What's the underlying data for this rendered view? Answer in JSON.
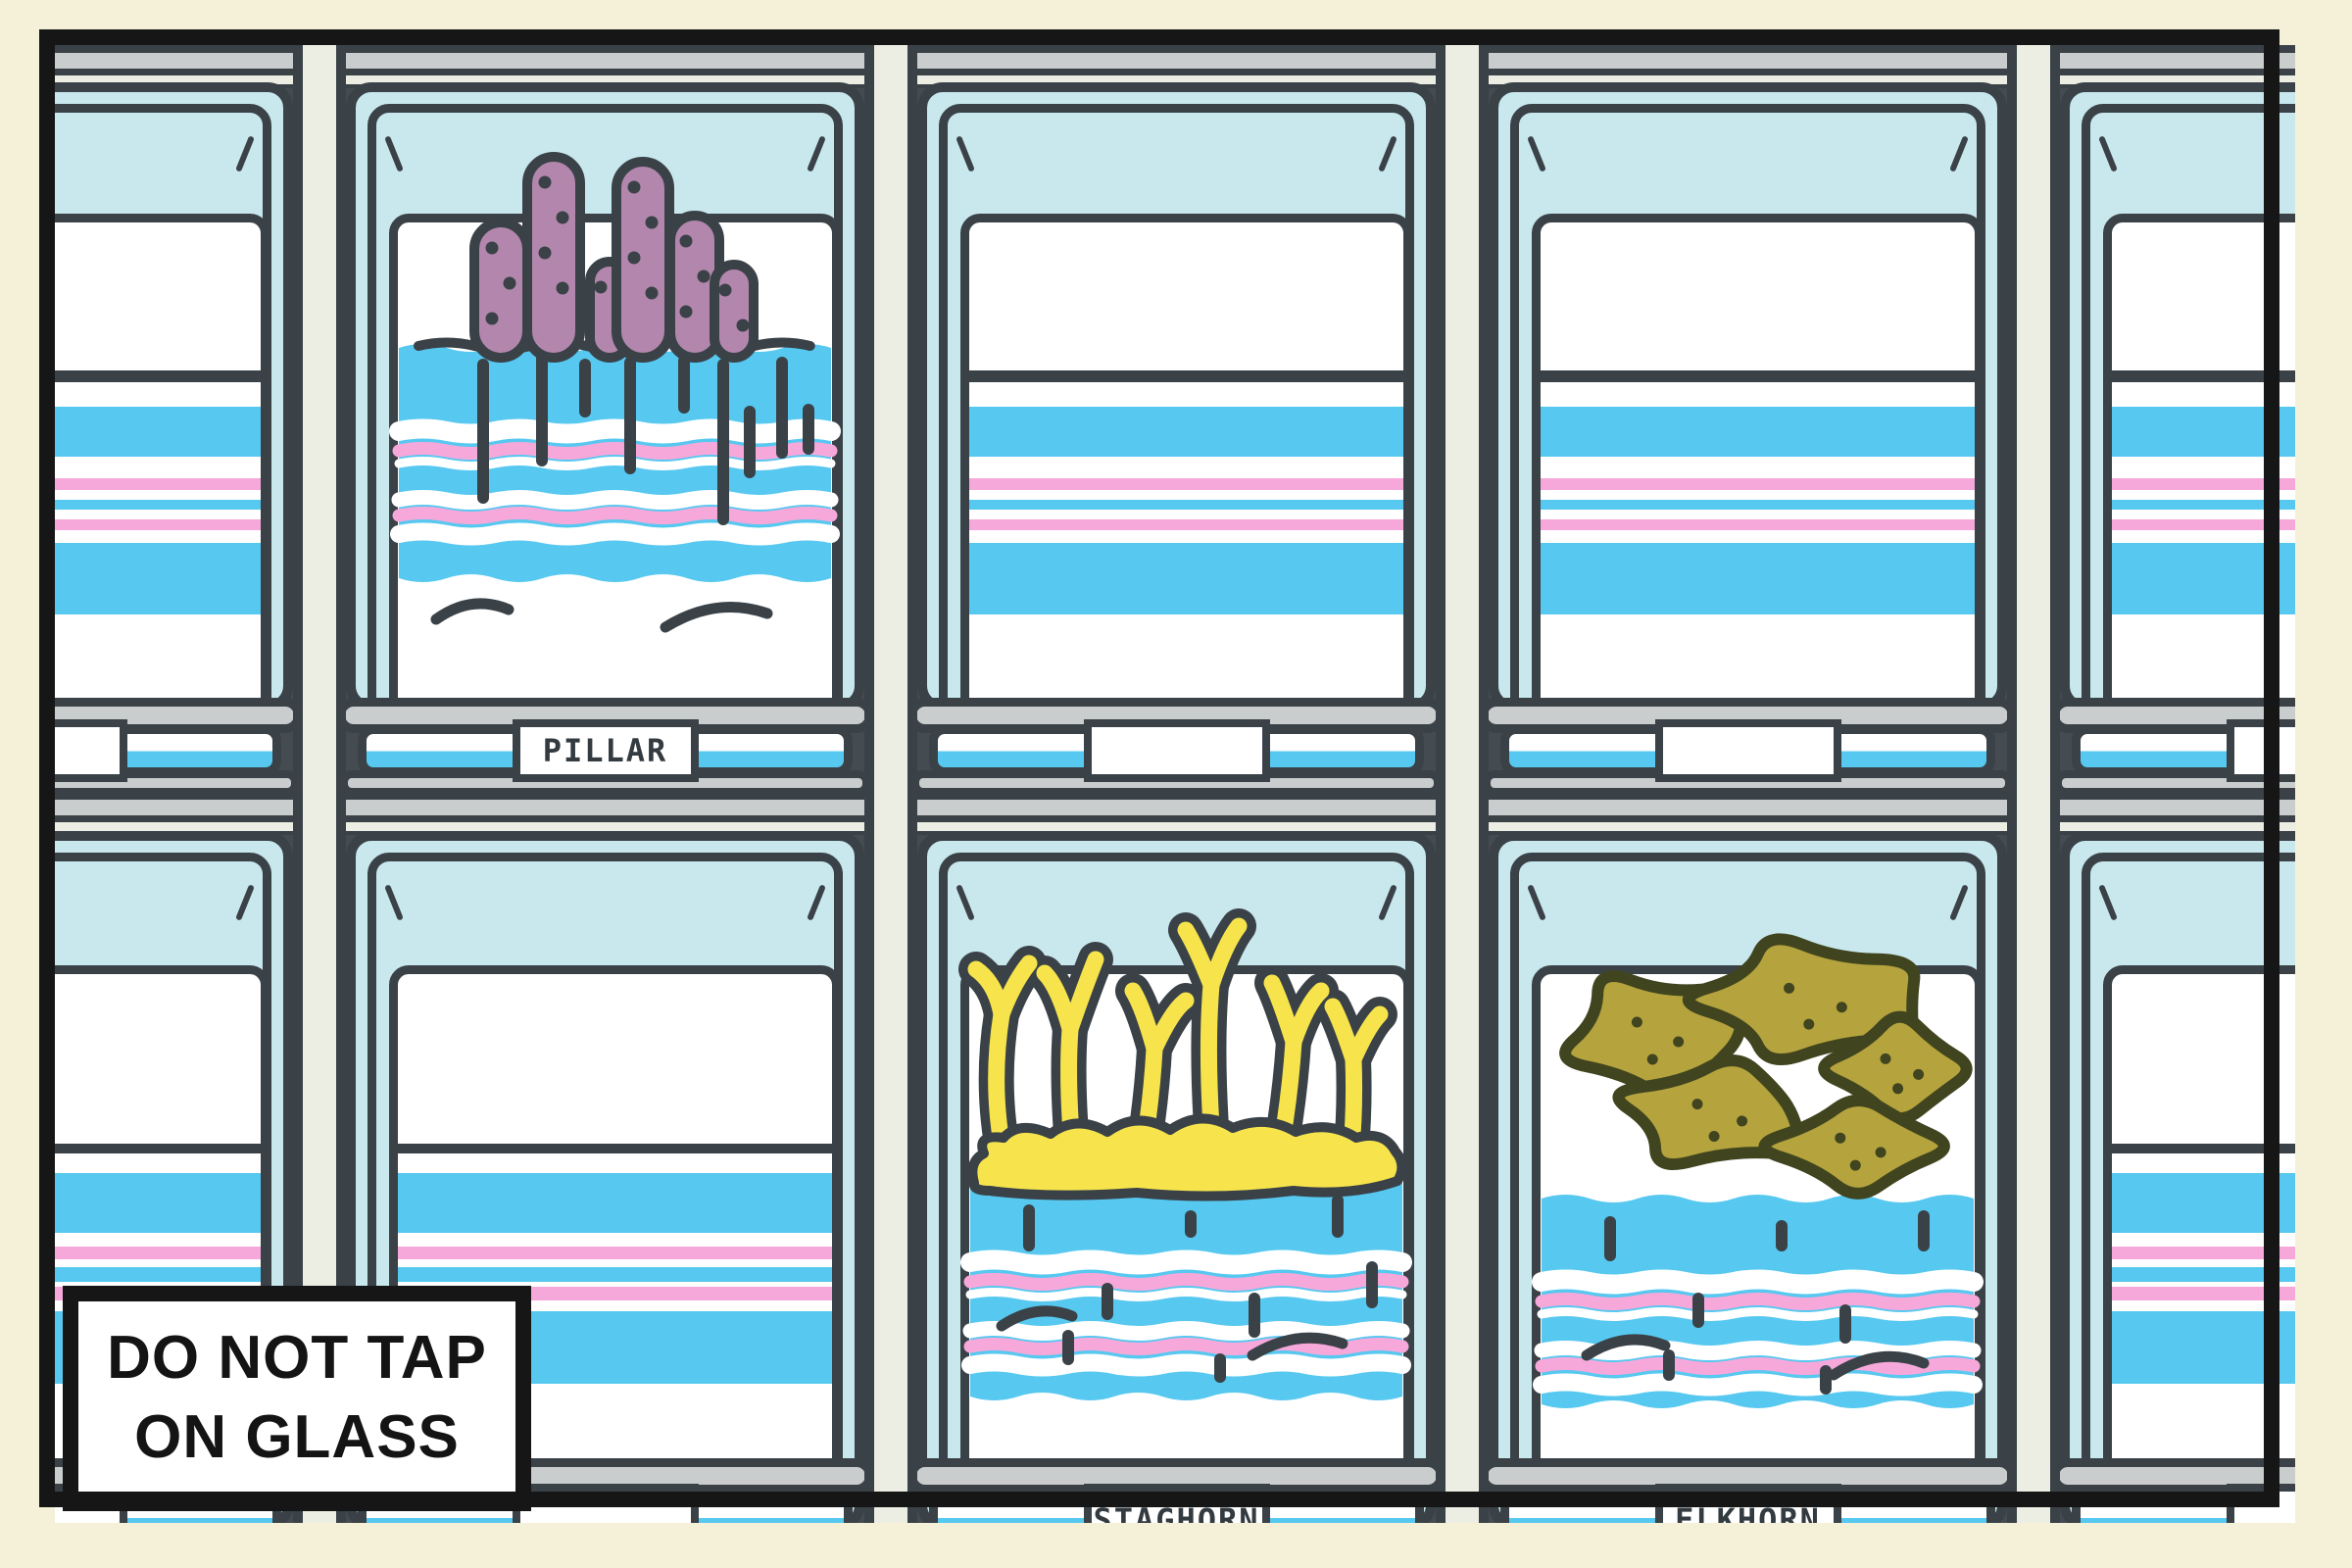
{
  "scene_description": "aquarium wall of coral tanks",
  "palette": {
    "cream": "#f4f1d8",
    "frame_black": "#161616",
    "outline": "#3a4248",
    "frame_gray": "#c9cdcd",
    "post": "#ecede3",
    "glass_cyan": "#c9e8ee",
    "water_blue": "#57c8f0",
    "stripe_pink": "#f7a8da",
    "card_white": "#ffffff",
    "pillar_mauve": "#b387ad",
    "staghorn_yellow": "#f7e44c",
    "elkhorn_olive": "#b5a33e",
    "elkhorn_outline": "#40451f",
    "label_text": "#333b41",
    "sign_text": "#141414"
  },
  "sign": {
    "line1": "DO NOT TAP",
    "line2": "ON GLASS"
  },
  "tanks": [
    {
      "id": "r1c1",
      "row": 1,
      "col": 1,
      "coral": null,
      "label": ""
    },
    {
      "id": "r1c2",
      "row": 1,
      "col": 2,
      "coral": "pillar",
      "label": "PILLAR"
    },
    {
      "id": "r1c3",
      "row": 1,
      "col": 3,
      "coral": null,
      "label": ""
    },
    {
      "id": "r1c4",
      "row": 1,
      "col": 4,
      "coral": null,
      "label": ""
    },
    {
      "id": "r1c5",
      "row": 1,
      "col": 5,
      "coral": null,
      "label": ""
    },
    {
      "id": "r2c1",
      "row": 2,
      "col": 1,
      "coral": null,
      "label": ""
    },
    {
      "id": "r2c2",
      "row": 2,
      "col": 2,
      "coral": null,
      "label": ""
    },
    {
      "id": "r2c3",
      "row": 2,
      "col": 3,
      "coral": "staghorn",
      "label": "STAGHORN"
    },
    {
      "id": "r2c4",
      "row": 2,
      "col": 4,
      "coral": "elkhorn",
      "label": "ELKHORN"
    },
    {
      "id": "r2c5",
      "row": 2,
      "col": 5,
      "coral": null,
      "label": ""
    }
  ]
}
